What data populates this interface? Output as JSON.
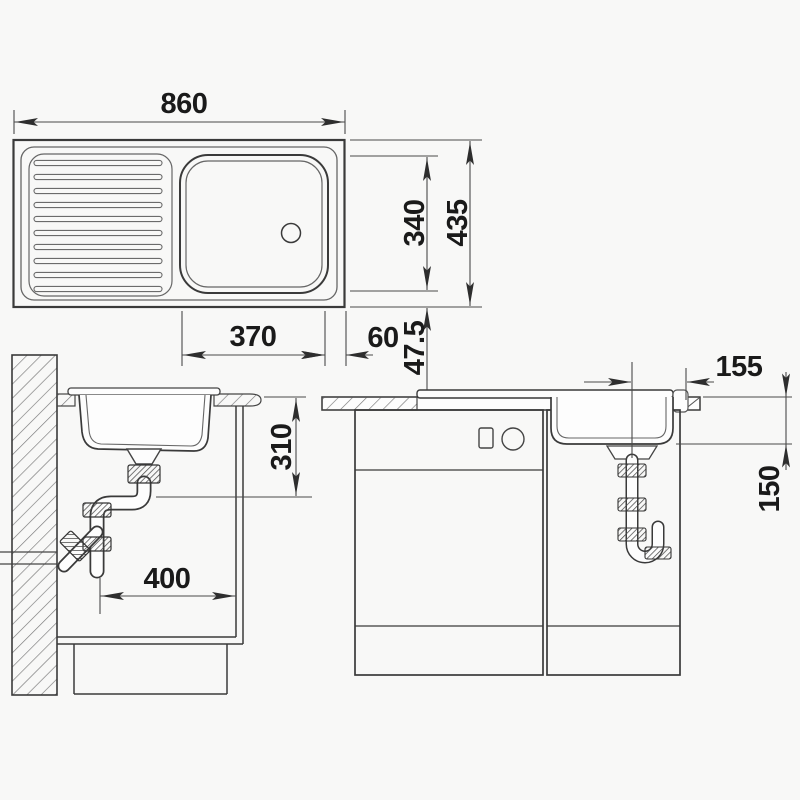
{
  "palette": {
    "background": "#f8f8f7",
    "line": "#3a3a3a",
    "dim_line": "#4a4a4a",
    "text": "#1a1a1a"
  },
  "views": {
    "top": {
      "dims": {
        "width": "860",
        "bowl_width": "370",
        "right_margin": "60",
        "bowl_depth": "340",
        "total_depth": "435",
        "edge_margin": "47.5"
      }
    },
    "side": {
      "dims": {
        "mount_depth": "310",
        "trap_clearance": "400"
      }
    },
    "front": {
      "dims": {
        "drain_offset": "155",
        "bowl_height": "150"
      }
    }
  }
}
